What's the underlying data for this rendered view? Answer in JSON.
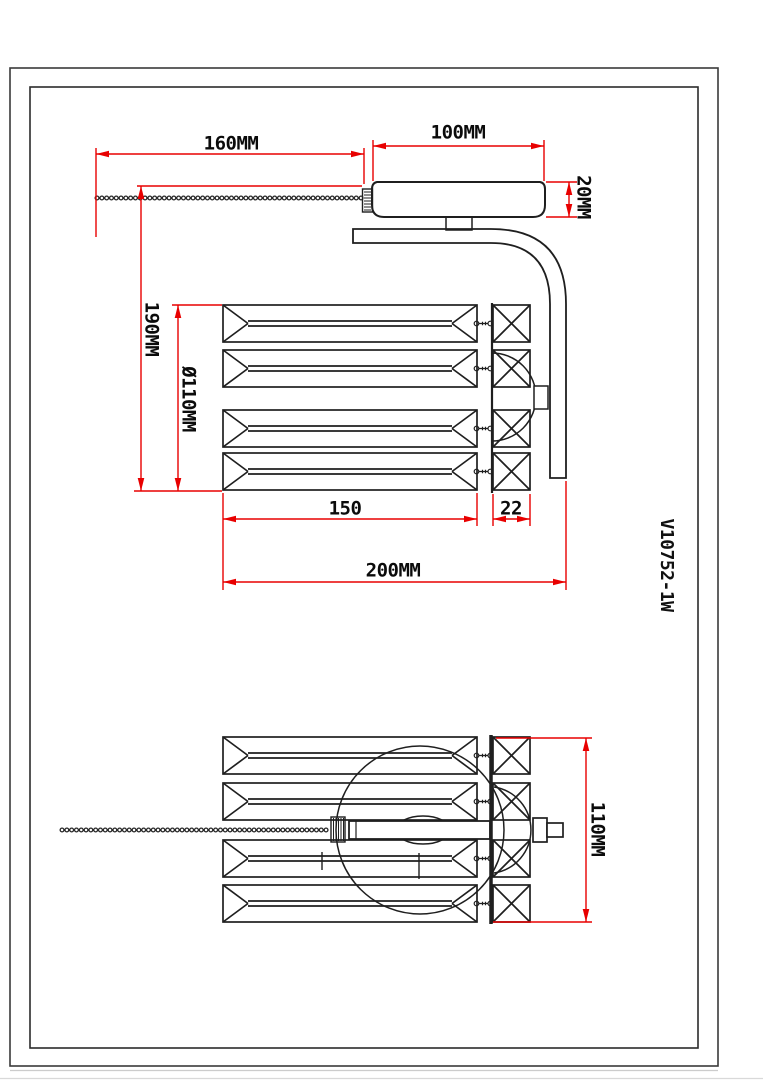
{
  "part_number": "V10752-1W",
  "dims": {
    "chain_length": "160MM",
    "canopy_width": "100MM",
    "canopy_thickness": "20MM",
    "overall_height": "190MM",
    "crystal_circle_diameter": "Ø110MM",
    "crystal_length": "150",
    "back_plate_width": "22",
    "overall_depth": "200MM",
    "body_width": "110MM"
  },
  "colors": {
    "dimension_red": "#e80000",
    "drawing_black": "#1f1f1f",
    "border_gray": "#3a3a3a"
  }
}
